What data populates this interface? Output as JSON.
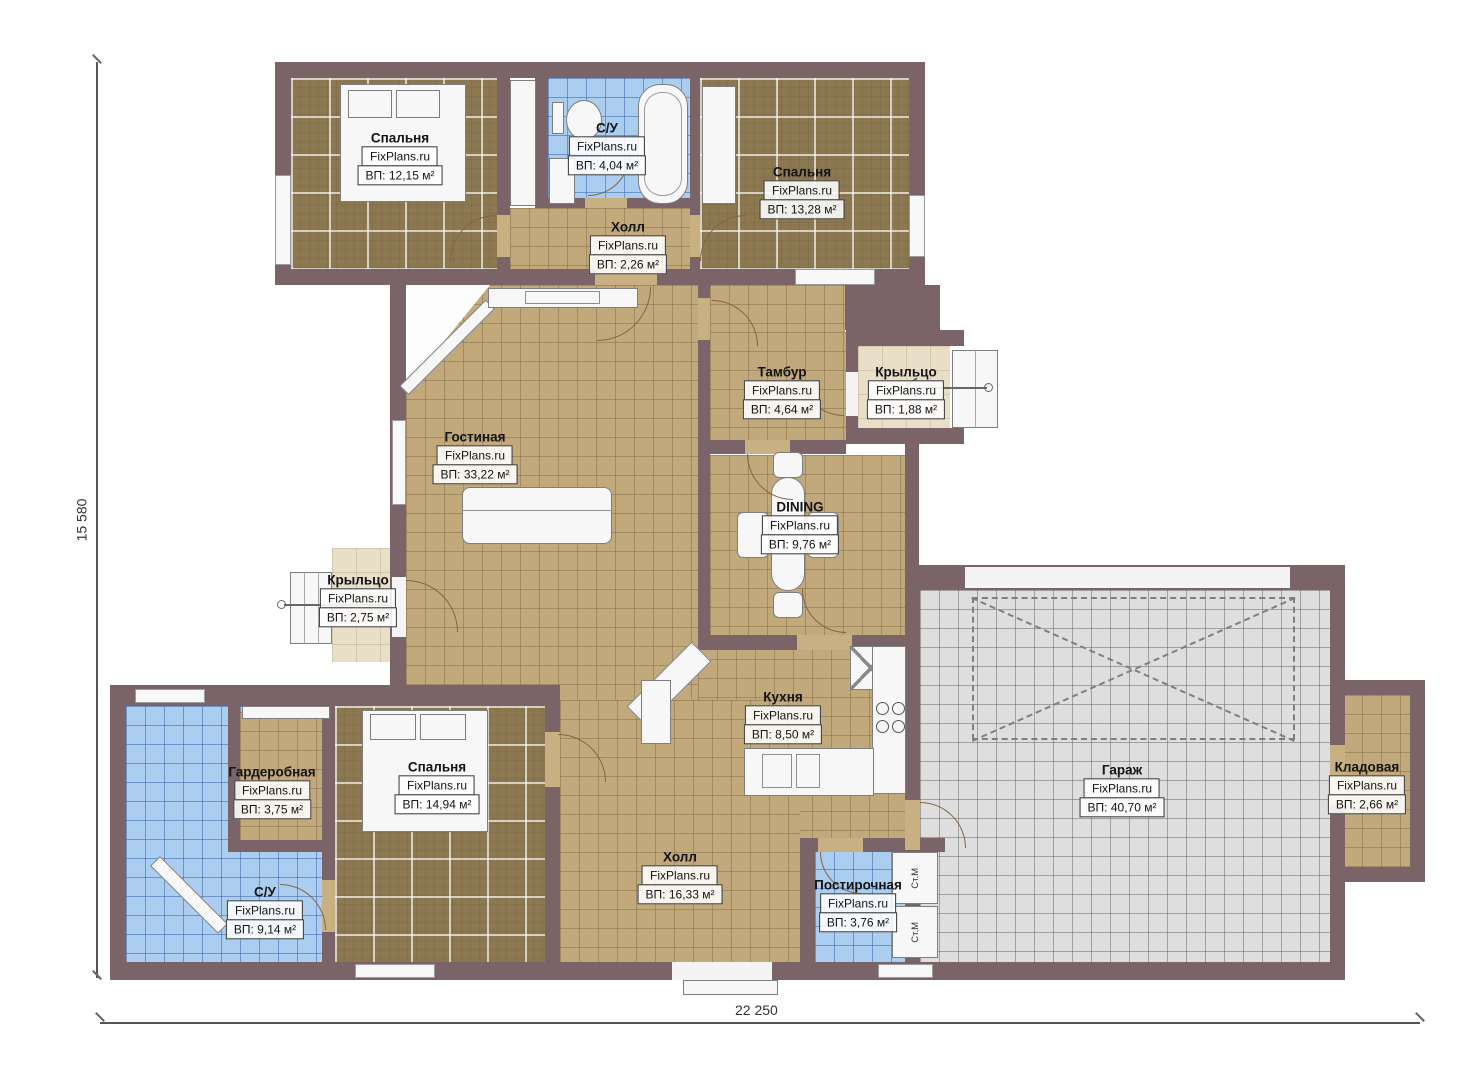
{
  "watermark": "FixPlans.ru",
  "rooms": [
    {
      "id": "bedroom-top-left",
      "name": "Спальня",
      "area": "ВП: 12,15 м²"
    },
    {
      "id": "bathroom-top",
      "name": "С/У",
      "area": "ВП: 4,04 м²"
    },
    {
      "id": "bedroom-top-right",
      "name": "Спальня",
      "area": "ВП: 13,28 м²"
    },
    {
      "id": "hall-top",
      "name": "Холл",
      "area": "ВП: 2,26 м²"
    },
    {
      "id": "tambur",
      "name": "Тамбур",
      "area": "ВП: 4,64 м²"
    },
    {
      "id": "porch-right",
      "name": "Крыльцо",
      "area": "ВП: 1,88 м²"
    },
    {
      "id": "living-room",
      "name": "Гостиная",
      "area": "ВП: 33,22 м²"
    },
    {
      "id": "dining",
      "name": "DINING",
      "area": "ВП: 9,76 м²"
    },
    {
      "id": "porch-left",
      "name": "Крыльцо",
      "area": "ВП: 2,75 м²"
    },
    {
      "id": "wardrobe",
      "name": "Гардеробная",
      "area": "ВП: 3,75 м²"
    },
    {
      "id": "bedroom-bottom",
      "name": "Спальня",
      "area": "ВП: 14,94 м²"
    },
    {
      "id": "kitchen",
      "name": "Кухня",
      "area": "ВП: 8,50 м²"
    },
    {
      "id": "hall-bottom",
      "name": "Холл",
      "area": "ВП: 16,33 м²"
    },
    {
      "id": "laundry",
      "name": "Постирочная",
      "area": "ВП: 3,76 м²"
    },
    {
      "id": "garage",
      "name": "Гараж",
      "area": "ВП: 40,70 м²"
    },
    {
      "id": "storage",
      "name": "Кладовая",
      "area": "ВП: 2,66 м²"
    },
    {
      "id": "bathroom-bottom",
      "name": "С/У",
      "area": "ВП: 9,14 м²"
    }
  ],
  "labels": {
    "washer": "Ст.М"
  },
  "dimensions": {
    "height_label": "15 580",
    "width_label": "22 250"
  },
  "colors": {
    "wall": "#7b6468",
    "floor_tan": "#c2a97b",
    "floor_bedroom": "#8b7850",
    "floor_bath": "#aacdf0",
    "floor_garage": "#dedede",
    "floor_porch": "#e9dfc9"
  }
}
